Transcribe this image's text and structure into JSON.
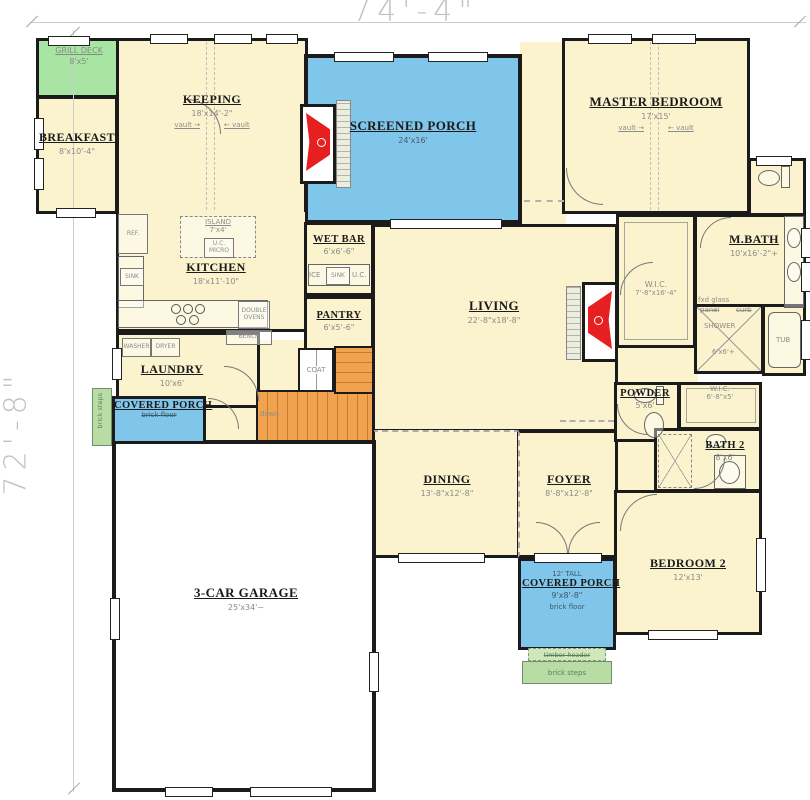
{
  "dimensions": {
    "width_label": "74'-4\"",
    "height_label": "72'-8\""
  },
  "rooms": {
    "grill_deck": {
      "name": "GRILL DECK",
      "dims": "8'x5'"
    },
    "breakfast": {
      "name": "BREAKFAST",
      "dims": "8'x10'-4\""
    },
    "keeping": {
      "name": "KEEPING",
      "dims": "18'x14'-2\"",
      "vault_left": "vault →",
      "vault_right": "← vault"
    },
    "screened_porch": {
      "name": "SCREENED PORCH",
      "dims": "24'x16'"
    },
    "master_bedroom": {
      "name": "MASTER BEDROOM",
      "dims": "17'x15'",
      "vault_left": "vault →",
      "vault_right": "← vault"
    },
    "mbath": {
      "name": "M.BATH",
      "dims": "10'x16'-2\"+"
    },
    "master_wic": {
      "name": "W.I.C.",
      "dims": "7'-8\"x16'-4\""
    },
    "shower": {
      "name": "SHOWER",
      "dims": "6'x6'+",
      "fxd_glass": "fxd glass",
      "panel": "panel",
      "curb": "curb"
    },
    "tub": {
      "name": "TUB"
    },
    "kitchen": {
      "name": "KITCHEN",
      "dims": "18'x11'-10\"",
      "island": "ISLAND",
      "island_dims": "7'x4'",
      "uc_micro": "U.C. MICRO",
      "ref": "REF.",
      "sink": "SINK",
      "double_ovens": "DOUBLE OVENS",
      "bench": "BENCH"
    },
    "wet_bar": {
      "name": "WET BAR",
      "dims": "6'x6'-6\"",
      "ice": "ICE",
      "sink": "SINK",
      "uc": "U.C."
    },
    "pantry": {
      "name": "PANTRY",
      "dims": "6'x5'-6\""
    },
    "living": {
      "name": "LIVING",
      "dims": "22'-8\"x18'-8\""
    },
    "laundry": {
      "name": "LAUNDRY",
      "dims": "10'x6'",
      "washer": "WASHER",
      "dryer": "DRYER"
    },
    "coat": {
      "name": "COAT"
    },
    "stairs": {
      "label": "down"
    },
    "covered_porch_left": {
      "name": "COVERED PORCH",
      "floor": "brick floor",
      "steps": "brick steps"
    },
    "dining": {
      "name": "DINING",
      "dims": "13'-8\"x12'-8\""
    },
    "foyer": {
      "name": "FOYER",
      "dims": "8'-8\"x12'-8\""
    },
    "powder": {
      "name": "POWDER",
      "dims": "5'x6'"
    },
    "wic2": {
      "name": "W.I.C.",
      "dims": "6'-8\"x5'"
    },
    "bath2": {
      "name": "BATH 2",
      "dims": "8'x6'"
    },
    "bedroom2": {
      "name": "BEDROOM 2",
      "dims": "12'x13'"
    },
    "garage": {
      "name": "3-CAR GARAGE",
      "dims": "25'x34'~"
    },
    "front_porch": {
      "height_note": "12' TALL",
      "name": "COVERED PORCH",
      "dims": "9'x8'-8\"",
      "floor": "brick floor",
      "header": "timber header",
      "steps": "brick steps"
    }
  },
  "colors": {
    "room_fill": "#FAF3CE",
    "porch_blue": "#7FC6EA",
    "deck_green": "#A9E5A2",
    "steps_green": "#B9DBA4",
    "stairs_orange": "#F0A24F",
    "fireplace_red": "#E62020",
    "wall": "#1B1B1B"
  }
}
